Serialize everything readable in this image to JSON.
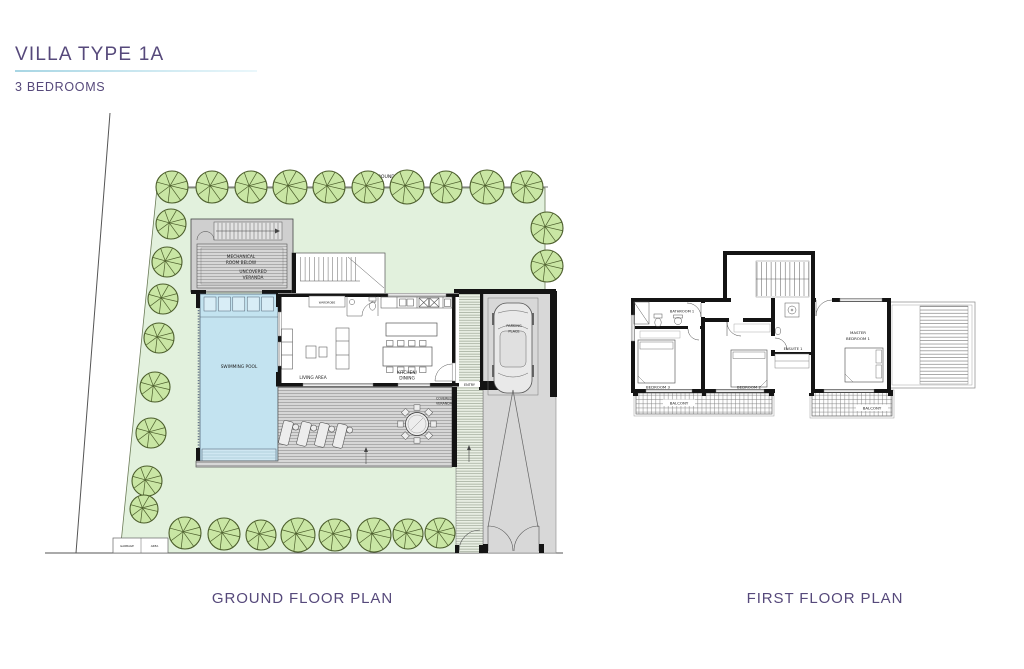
{
  "page": {
    "title": "VILLA TYPE 1A",
    "subtitle": "3 BEDROOMS"
  },
  "colors": {
    "accent": "#56497B",
    "underline": "#A8D6E4",
    "plot_green": "#E2F1DD",
    "tree_fill": "#C9E6A4",
    "tree_stroke": "#4C5E2C",
    "pool_blue": "#C3E3F0",
    "pool_steps": "#D8EDF6",
    "deck_gray": "#D7D7D7",
    "drive_gray": "#D8D8D8",
    "wall_black": "#141414"
  },
  "ground_floor": {
    "caption": "GROUND FLOOR PLAN",
    "labels": {
      "plot_boundary": "PLOT BOUNDARY LINE",
      "mechanical_1": "MECHANICAL",
      "mechanical_2": "ROOM BELOW",
      "uncovered_1": "UNCOVERED",
      "uncovered_2": "VERANDA",
      "wardrobe": "WARDROBE",
      "swimming_pool": "SWIMMING POOL",
      "living_area": "LIVING AREA",
      "kitchen_1": "KITCHEN/",
      "kitchen_2": "DINING",
      "covered_1": "COVERED",
      "covered_2": "VERANDA",
      "entry": "ENTRY",
      "parking_1": "PARKING",
      "parking_2": "PLACE",
      "garbage_1": "GARBAGE",
      "garbage_2": "AREA"
    }
  },
  "first_floor": {
    "caption": "FIRST FLOOR PLAN",
    "labels": {
      "bathroom": "BATHROOM 1",
      "bedroom3": "BEDROOM 3",
      "bedroom2": "BEDROOM 2",
      "ensuite": "ENSUITE 1",
      "master_1": "MASTER",
      "master_2": "BEDROOM 1",
      "balcony_left": "BALCONY",
      "balcony_right": "BALCONY"
    }
  }
}
